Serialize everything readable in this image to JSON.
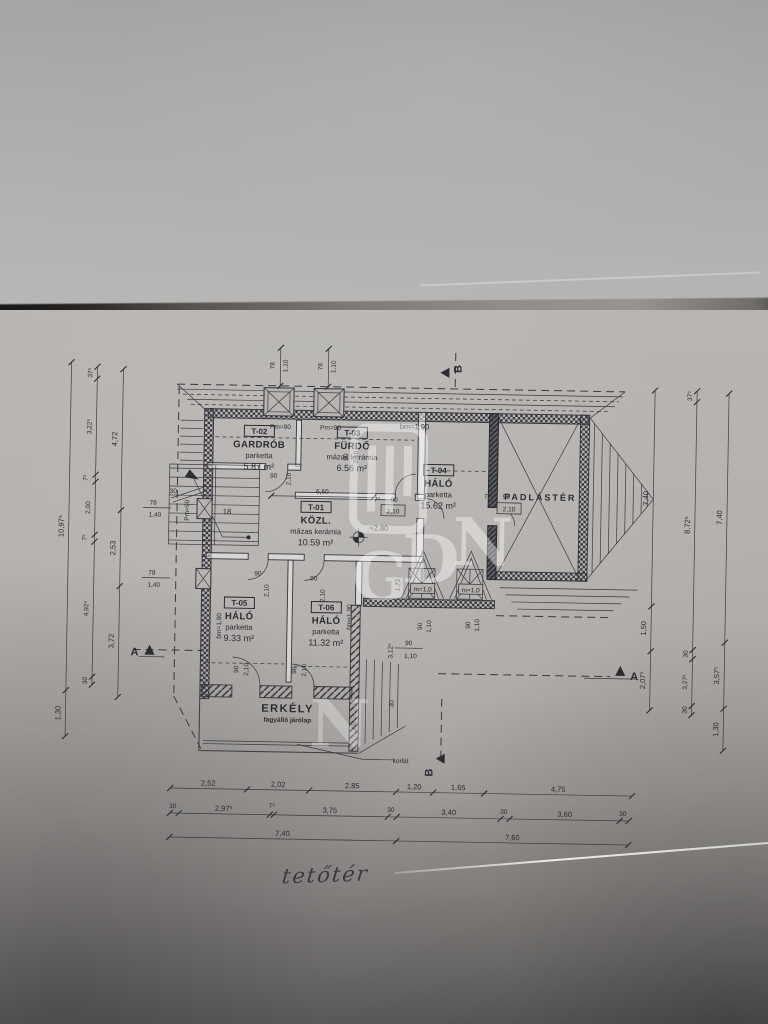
{
  "photo": {
    "note": "tetőtér"
  },
  "watermark": {
    "l1": "G",
    "l2": "D",
    "l3": "N",
    "l4": "N"
  },
  "rooms": {
    "t01": {
      "code": "T-01",
      "name": "KÖZL.",
      "finish": "mázas kerámia",
      "area": "10.59 m²"
    },
    "t02": {
      "code": "T-02",
      "name": "GARDRÓB",
      "finish": "parketta",
      "area": "5.87 m²"
    },
    "t03": {
      "code": "T-03",
      "name": "FÜRDŐ",
      "finish": "mázas kerámia",
      "area": "6.56 m²"
    },
    "t04": {
      "code": "T-04",
      "name": "HÁLÓ",
      "finish": "parketta",
      "area": "15.62 m²"
    },
    "t05": {
      "code": "T-05",
      "name": "HÁLÓ",
      "finish": "parketta",
      "area": "9.33 m²"
    },
    "t06": {
      "code": "T-06",
      "name": "HÁLÓ",
      "finish": "parketta",
      "area": "11.32 m²"
    },
    "attic": {
      "name": "PADLÁSTÉR"
    },
    "balcony": {
      "name": "ERKÉLY",
      "finish": "fagyálló járólap"
    }
  },
  "annotations": {
    "pm90": "Pm=90",
    "bm190": "bm=1,90",
    "m10": "m=1,0",
    "level": "+2.80",
    "stairs": "18",
    "korlat": "korlát",
    "a": "A",
    "b": "B"
  },
  "dims": {
    "left_outer": [
      "10,97⁵",
      "1,30"
    ],
    "left_mid": [
      "37⁵",
      "3,22⁵",
      "7⁵",
      "2,00",
      "7⁵",
      "4,92⁵",
      "30"
    ],
    "left_inner": [
      "4,72",
      "2,53",
      "3,72"
    ],
    "right_inner": [
      "7,40",
      "1,50",
      "2,07⁵"
    ],
    "right_mid": [
      "37⁵",
      "8,72⁵",
      "30",
      "3,27⁵",
      "30"
    ],
    "right_outer": [
      "7,40",
      "3,57⁵",
      "1,30"
    ],
    "bottom_row1": [
      "2,52",
      "2,02",
      "2,85",
      "1,20",
      "1,65",
      "4,75"
    ],
    "bottom_row2": [
      "30",
      "2,97⁵",
      "7⁵",
      "3,75",
      "30",
      "3,40",
      "30",
      "3,60",
      "30"
    ],
    "bottom_row3": [
      "7,40",
      "7,60"
    ],
    "roof_window_sill": "78",
    "roof_window_w": "1,10",
    "side_window_sill": "78",
    "side_window_w": "1,40",
    "door_w": "90",
    "door_h": "2,10",
    "wall_thin": "7⁵",
    "dim_660": "6,60",
    "dim_3125": "3,12⁵",
    "dim_172": "1,72",
    "dim_30": "30",
    "dormer_w": "90",
    "dormer_h": "1,10"
  }
}
